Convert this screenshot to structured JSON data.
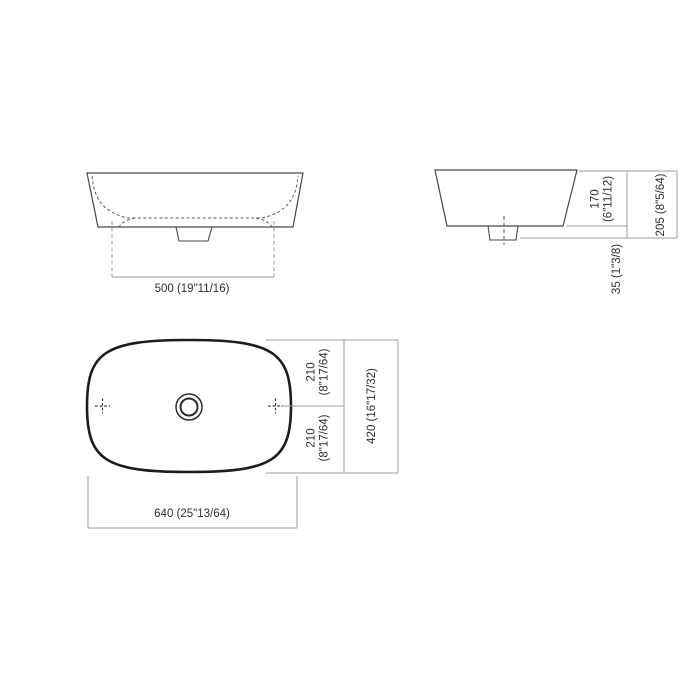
{
  "drawing": {
    "subject": "countertop-basin-technical-drawing",
    "colors": {
      "background": "#ffffff",
      "object_outline": "#474747",
      "plan_outline": "#1c1c1c",
      "hidden_line": "#5a5a5a",
      "dimension_line": "#9b9b9b",
      "text": "#2f2f2f"
    },
    "views": {
      "front": {
        "width_dim": "500 (19\"11/16)"
      },
      "side": {
        "basin_height_dim_line1": "170",
        "basin_height_dim_line2": "(6\"11/12)",
        "total_height_dim": "205 (8\"5/64)",
        "base_height_dim": "35 (1\"3/8)"
      },
      "plan": {
        "upper_half_depth_line1": "210",
        "upper_half_depth_line2": "(8\"17/64)",
        "lower_half_depth_line1": "210",
        "lower_half_depth_line2": "(8\"17/64)",
        "total_depth_dim": "420 (16\"17/32)",
        "total_width_dim": "640 (25\"13/64)"
      }
    }
  }
}
